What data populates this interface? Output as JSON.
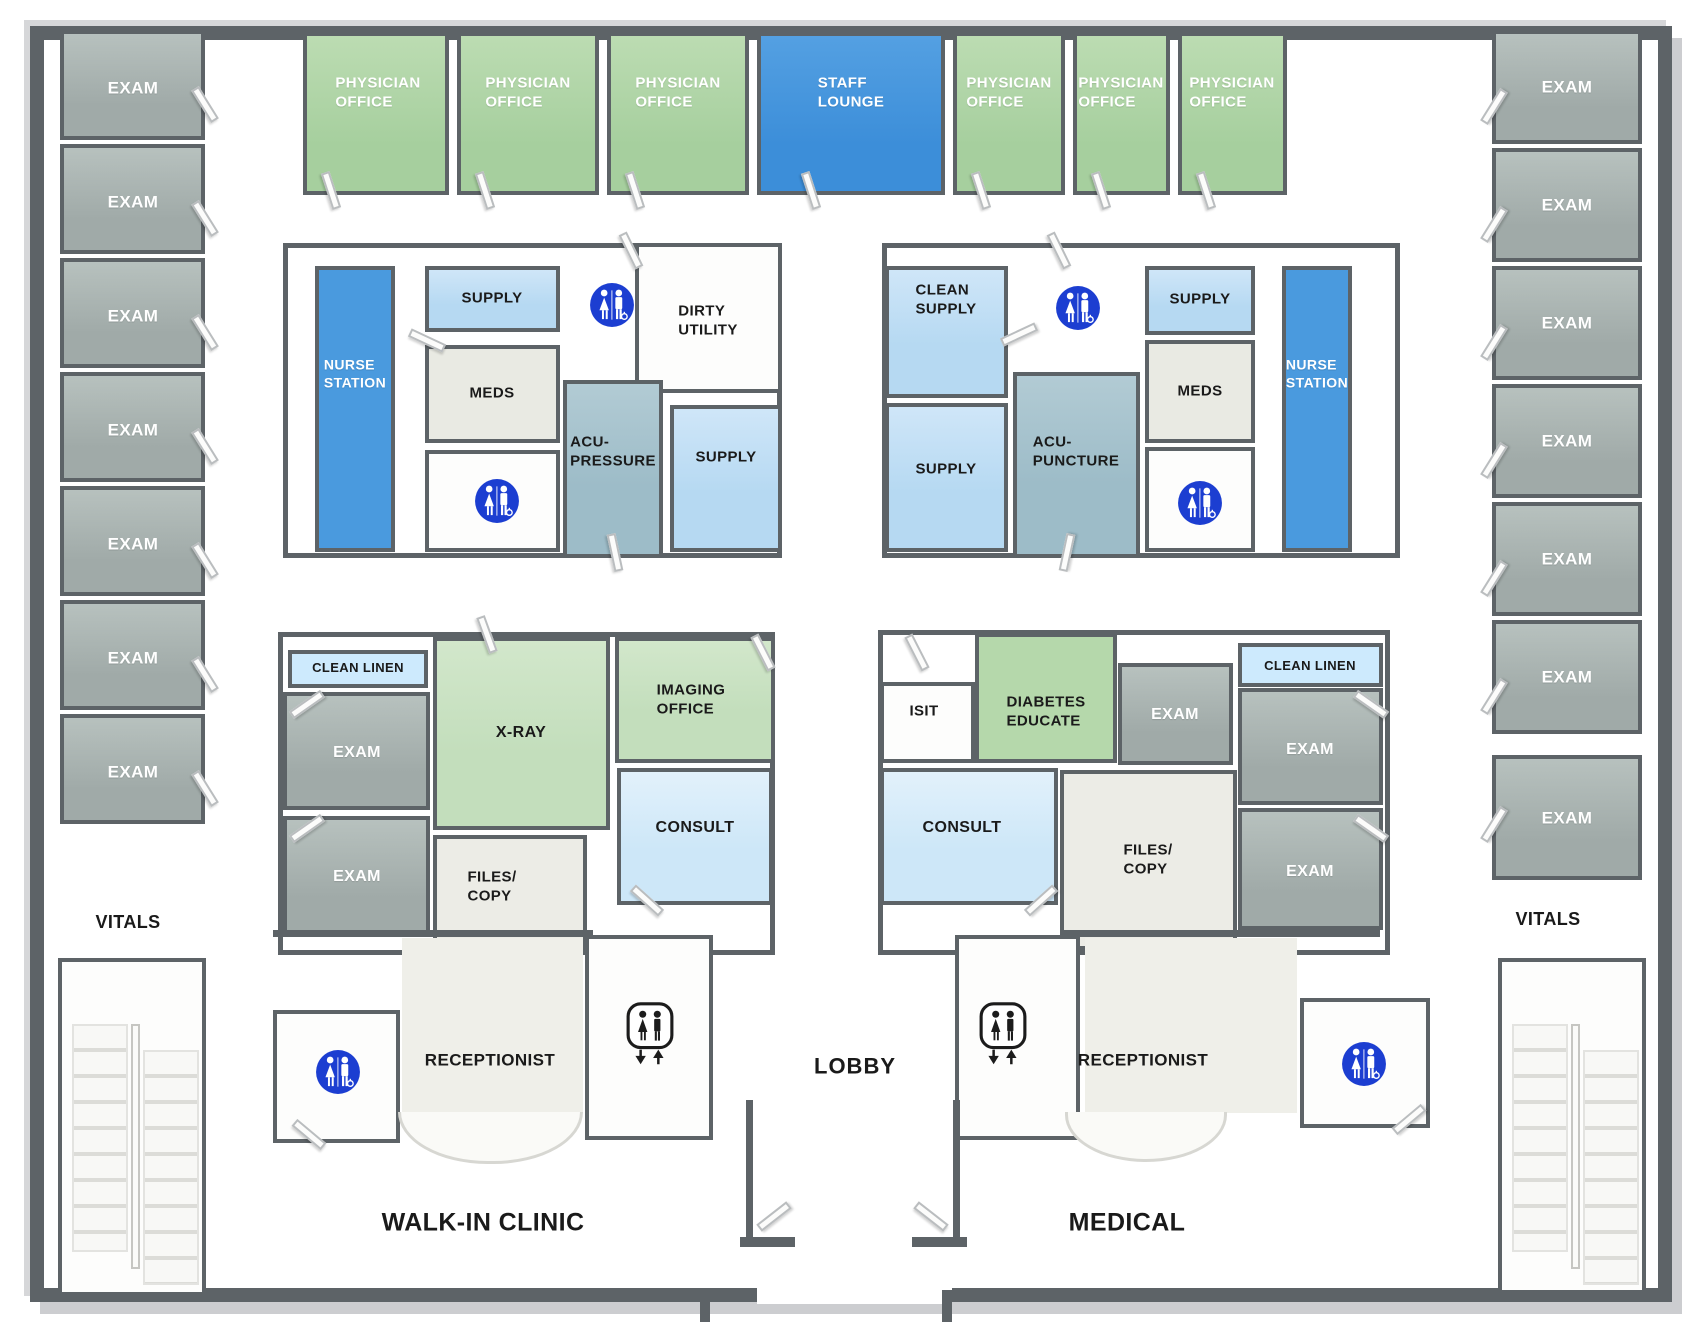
{
  "canvas": {
    "width": 1700,
    "height": 1324
  },
  "colors": {
    "wall": "#5d6367",
    "exam": "#a0aaa8",
    "physician": "#a6cf9e",
    "lounge": "#3c8ed9",
    "nurse": "#4a9ade",
    "supply": "#b6d9f2",
    "meds": "#e9eae3",
    "acu": "#9dbcc8",
    "xray": "#c3debc",
    "diabetes": "#b5d8ab",
    "consult": "#cde7f8",
    "linen": "#cdeafd",
    "files": "#ecece6",
    "restroom": "#1c3ed1",
    "floor_tint": "#efefe9"
  },
  "icons": {
    "restroom": "unisex-accessible-restroom",
    "elevator": "elevator",
    "stairs": "staircase",
    "door": "door-swing"
  },
  "top_row": {
    "offices_left": [
      "PHYSICIAN\nOFFICE",
      "PHYSICIAN\nOFFICE",
      "PHYSICIAN\nOFFICE"
    ],
    "staff_lounge": "STAFF\nLOUNGE",
    "offices_right": [
      "PHYSICIAN\nOFFICE",
      "PHYSICIAN\nOFFICE",
      "PHYSICIAN\nOFFICE"
    ]
  },
  "west_wing": {
    "exams": [
      "EXAM",
      "EXAM",
      "EXAM",
      "EXAM",
      "EXAM",
      "EXAM",
      "EXAM"
    ],
    "vitals": "VITALS"
  },
  "east_wing": {
    "exams": [
      "EXAM",
      "EXAM",
      "EXAM",
      "EXAM",
      "EXAM",
      "EXAM",
      "EXAM"
    ],
    "vitals": "VITALS"
  },
  "west_cluster": {
    "nurse_station": "NURSE\nSTATION",
    "supply": "SUPPLY",
    "meds": "MEDS",
    "dirty_utility": "DIRTY\nUTILITY",
    "acupressure": "ACU-\nPRESSURE",
    "supply2": "SUPPLY"
  },
  "east_cluster": {
    "clean_supply": "CLEAN\nSUPPLY",
    "supply": "SUPPLY",
    "meds": "MEDS",
    "nurse_station": "NURSE\nSTATION",
    "acupuncture": "ACU-\nPUNCTURE",
    "supply2": "SUPPLY"
  },
  "southwest_cluster": {
    "clean_linen": "CLEAN LINEN",
    "exam1": "EXAM",
    "exam2": "EXAM",
    "xray": "X-RAY",
    "imaging_office": "IMAGING\nOFFICE",
    "consult": "CONSULT",
    "files_copy": "FILES/\nCOPY"
  },
  "southeast_cluster": {
    "isit": "ISIT",
    "diabetes_educate": "DIABETES\nEDUCATE",
    "exam1": "EXAM",
    "clean_linen": "CLEAN LINEN",
    "exam2": "EXAM",
    "consult": "CONSULT",
    "files_copy": "FILES/\nCOPY",
    "exam3": "EXAM"
  },
  "south": {
    "receptionist_left": "RECEPTIONIST",
    "receptionist_right": "RECEPTIONIST",
    "lobby": "LOBBY",
    "walk_in_clinic": "WALK-IN CLINIC",
    "medical": "MEDICAL"
  }
}
